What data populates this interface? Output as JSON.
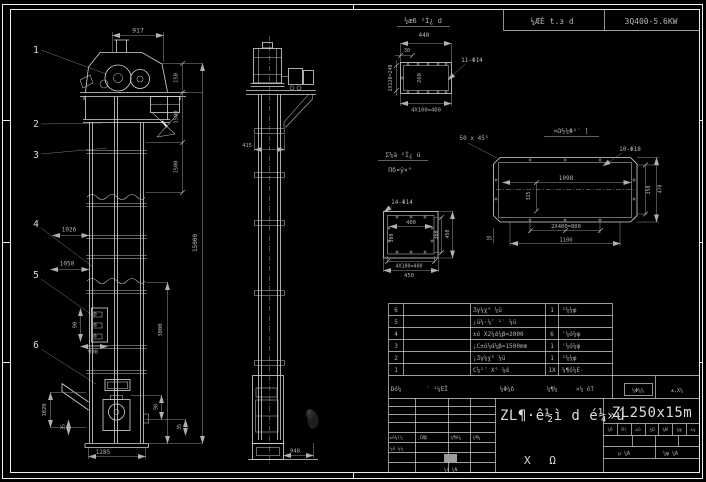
{
  "header": {
    "view_a_label": "½æ6 ¹Ì¿ d",
    "cell_left": "¼ÆÈ t.з d",
    "cell_right": "3Q400-5.6KW"
  },
  "callouts": [
    "1",
    "2",
    "3",
    "4",
    "5",
    "6"
  ],
  "front": {
    "dim_width": "917",
    "dim_h1": "150",
    "dim_h2": "1500",
    "dim_h3": "1500",
    "dim_h4": "3000",
    "dim_total": "15000",
    "dim_left1": "1026",
    "dim_left2": "1050",
    "dim_bucket_w": "90",
    "dim_bucket_h": "998",
    "dim_boot_l1": "1020",
    "dim_boot_l2": "35",
    "dim_boot_r1": "90",
    "dim_boot_r2": "35",
    "dim_boot_w": "1285"
  },
  "side": {
    "dim_flange": "415",
    "dim_base": "948"
  },
  "detail_a": {
    "dim_w": "440",
    "dim_off": "30",
    "dim_left": "2X120=240",
    "dim_inner": "260",
    "holes": "11-Φ14",
    "dim_bottom": "4X100=400"
  },
  "labels": {
    "frac_top": "Σ¼ä ¹Ì¿ ü",
    "frac_bottom": "Πδ¤ÿ×°"
  },
  "detail_c": {
    "holes": "14-Φ14",
    "dim_top": "400",
    "dim_left": "300",
    "dim_right_in": "360",
    "dim_right_out": "450",
    "dim_bottom1": "4X100=400",
    "dim_bottom2": "450"
  },
  "detail_b": {
    "title": "¤Ω½¼Φ¹′ ]",
    "chamfer": "50 x 45°",
    "holes": "10-Φ18",
    "dim_w": "1098",
    "dim_l": "325",
    "dim_r1": "350",
    "dim_r2": "470",
    "dim_b1": "2X400=800",
    "dim_b2": "1100",
    "dim_corner": "35"
  },
  "bom": {
    "rows": [
      {
        "no": "6",
        "code": "",
        "name": "Ʒγ¼χ° ¼ü",
        "qty": "1",
        "mat": "²¼¼φ"
      },
      {
        "no": "5",
        "code": "",
        "name": "¡ü¼·¼″ ¹′ ¼ü",
        "qty": "",
        "mat": ""
      },
      {
        "no": "4",
        "code": "",
        "name": "±ό X2¼ά¼β=2000",
        "qty": "6",
        "mat": "'¼ό¼φ"
      },
      {
        "no": "3",
        "code": "",
        "name": "¡C±ό¼ά¼β=1500mm",
        "qty": "1",
        "mat": "'¼ό¼φ"
      },
      {
        "no": "2",
        "code": "",
        "name": "¡Ʒγ¼χ° ¼ü",
        "qty": "1",
        "mat": "²¼¼φ"
      },
      {
        "no": "1",
        "code": "",
        "name": "C¼¹″ X° ¼ά",
        "qty": "1X",
        "mat": "¼¶ό¼Ε·"
      }
    ],
    "header": {
      "no": "Dό¼",
      "code": "′ ¹¼ΕΪ",
      "name": "¼Φ¼δ",
      "qty": "¼¶¼",
      "mat": "×¼ όT",
      "weight": "¼Φ¼¼",
      "scale": "±,Χ¼"
    }
  },
  "title_block": {
    "main_title": "ZL¶·ê½ì d é¼»ú",
    "model": "ZL250x15m",
    "drawing_type": "Χ Ω",
    "rev_row": [
      "±ό¼(¼′",
      "¸Ώ䶼",
      "¼¶Χ¼",
      "¼¶¼"
    ],
    "design_label": "¼ό ¼¼",
    "check_label": "¼ό ¼Ν",
    "info_cells": [
      "¼δ",
      "Rί",
      "±ύ",
      "¼Ω",
      "¼Ν",
      "¼ψ",
      "±γ"
    ],
    "sheet_left": "μ ¼Ά",
    "sheet_right": "¼ψ ¼Ά"
  }
}
